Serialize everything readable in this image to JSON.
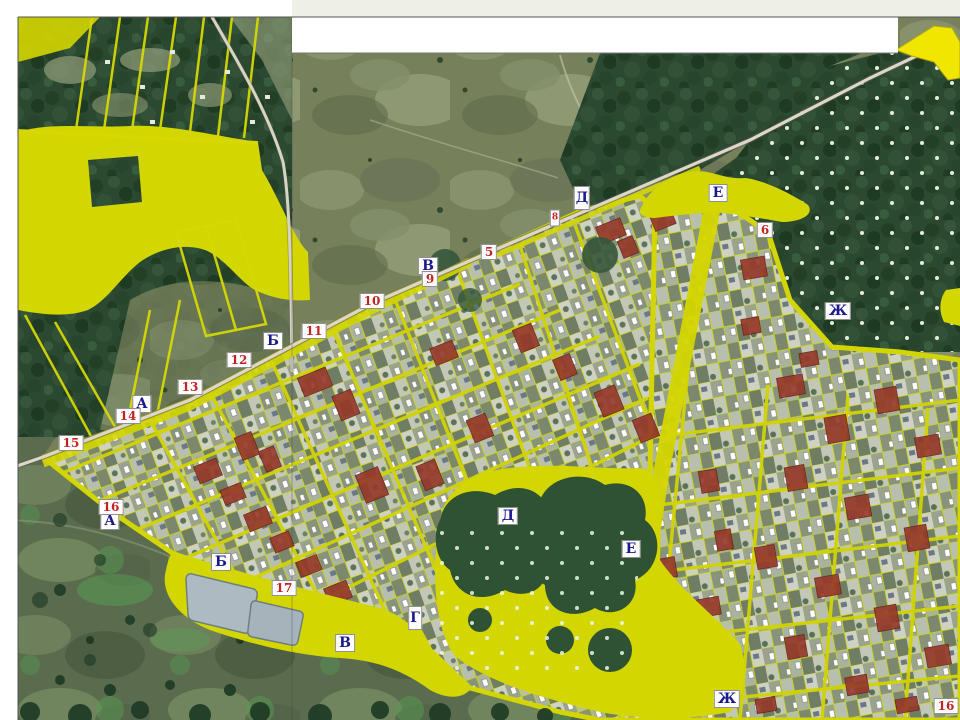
{
  "map_labels": {
    "letters": [
      {
        "text": "Д"
      },
      {
        "text": "Е"
      },
      {
        "text": "Ж"
      },
      {
        "text": "В"
      },
      {
        "text": "Б"
      },
      {
        "text": "А"
      },
      {
        "text": "А"
      },
      {
        "text": "Б"
      },
      {
        "text": "В"
      },
      {
        "text": "Г"
      },
      {
        "text": "Д"
      },
      {
        "text": "Е"
      },
      {
        "text": "Ж"
      }
    ],
    "numbers": [
      {
        "text": "5"
      },
      {
        "text": "6"
      },
      {
        "text": "8"
      },
      {
        "text": "9"
      },
      {
        "text": "10"
      },
      {
        "text": "11"
      },
      {
        "text": "12"
      },
      {
        "text": "13"
      },
      {
        "text": "14"
      },
      {
        "text": "15"
      },
      {
        "text": "16"
      },
      {
        "text": "17"
      },
      {
        "text": "16"
      }
    ]
  },
  "colors": {
    "overlay_yellow": "#d4d600",
    "bright_yellow_wedge": "#f0e600",
    "red_parcel": "#96392b",
    "forest_green": "#2c4a30",
    "dotted_forest_green": "#2f5134",
    "field_olive": "#76805b",
    "field_dark_green": "#5b6c4e",
    "pond_gray": "#adbac1",
    "letter_label_blue": "#1a1a8e",
    "number_label_red": "#c42222",
    "road_light": "#dcd7c8"
  }
}
